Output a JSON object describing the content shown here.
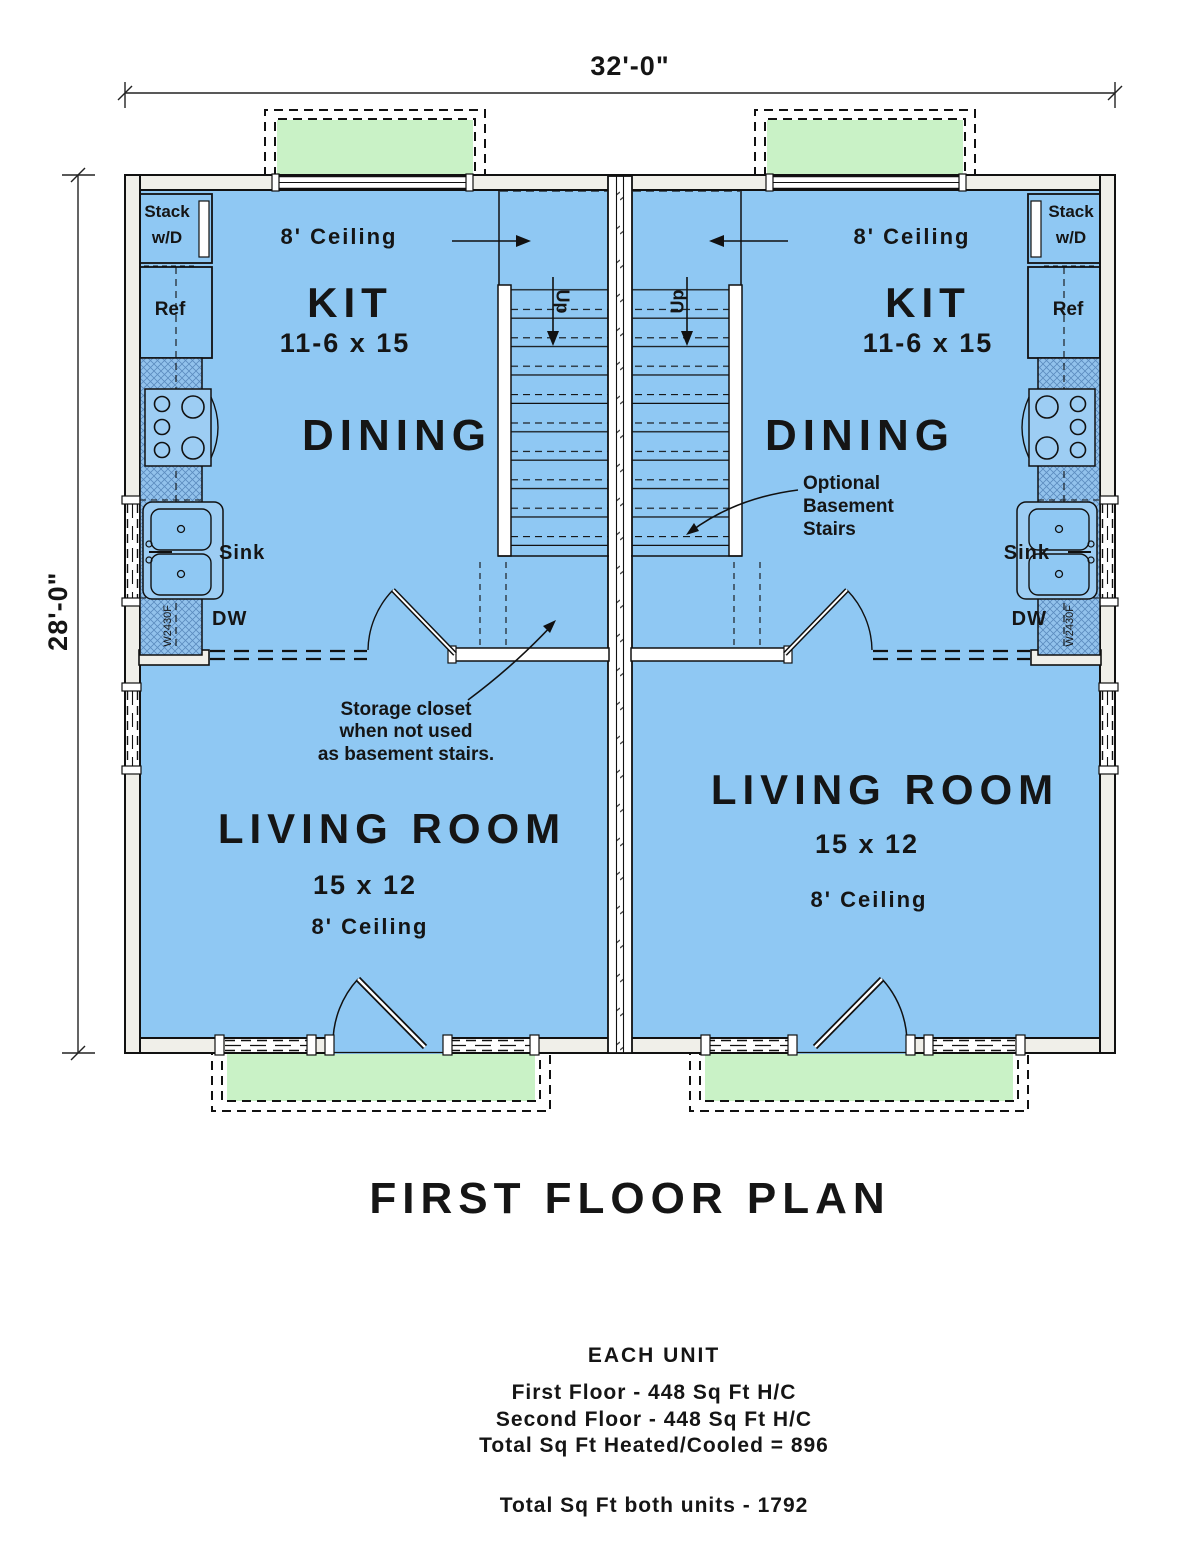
{
  "plan": {
    "title": "FIRST FLOOR PLAN",
    "dim_width": "32'-0\"",
    "dim_height": "28'-0\""
  },
  "left_unit": {
    "kitchen_ceiling": "8' Ceiling",
    "kitchen_name": "KIT",
    "kitchen_size": "11-6 x 15",
    "dining": "DINING",
    "stack_line1": "Stack",
    "stack_line2": "w/D",
    "ref": "Ref",
    "sink": "Sink",
    "dw": "DW",
    "cabinet_code": "W2430F",
    "up": "Up",
    "note_line1": "Storage closet",
    "note_line2": "when not used",
    "note_line3": "as basement stairs.",
    "living_name": "LIVING ROOM",
    "living_size": "15 x 12",
    "living_ceiling": "8' Ceiling"
  },
  "right_unit": {
    "kitchen_ceiling": "8' Ceiling",
    "kitchen_name": "KIT",
    "kitchen_size": "11-6 x 15",
    "dining": "DINING",
    "stack_line1": "Stack",
    "stack_line2": "w/D",
    "ref": "Ref",
    "sink": "Sink",
    "dw": "DW",
    "cabinet_code": "W2430F",
    "up": "Up",
    "note_line1": "Optional",
    "note_line2": "Basement",
    "note_line3": "Stairs",
    "living_name": "LIVING ROOM",
    "living_size": "15 x 12",
    "living_ceiling": "8' Ceiling"
  },
  "footer": {
    "each_unit": "EACH UNIT",
    "first_floor": "First Floor - 448 Sq Ft H/C",
    "second_floor": "Second Floor - 448 Sq Ft H/C",
    "total_hc": "Total Sq Ft Heated/Cooled = 896",
    "total_both": "Total Sq Ft both units - 1792"
  },
  "colors": {
    "floor": "#8fc8f3",
    "porch": "#c9f2c6",
    "counter": "#92c2ec",
    "wall": "#f0efe9"
  }
}
